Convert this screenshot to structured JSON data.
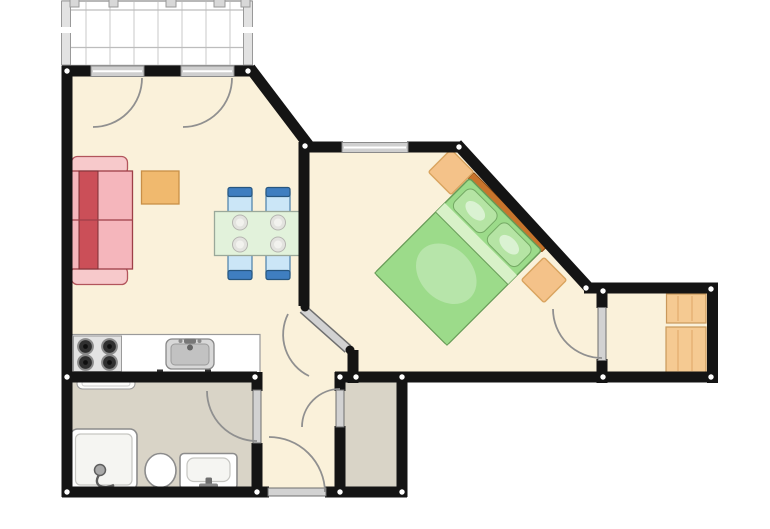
{
  "plan": {
    "colors": {
      "background": "#FFFFFF",
      "floor": "#FAF1DA",
      "wet_floor": "#D9D4C7",
      "wall": "#141414",
      "door_leaf": "#D2D2D2",
      "threshold": "#CFCFCF",
      "swing_arc": "#909090",
      "balcony_grid": "#C9C9C9",
      "balcony_rail": "#E2E2E2",
      "wood": "#F5CA92",
      "side_table_orange": "#F0B96E",
      "nightstand_orange": "#F4C289",
      "bed_green": "#9CDB8A",
      "pillow_green": "#B5E4A4",
      "sheet_green": "#D8F1C8",
      "headboard_brown": "#C8742C",
      "table_green": "#E2F2DB",
      "chair_blue": "#3F7EC0",
      "chair_seat_blue": "#CBE6F7",
      "sofa_pink": "#F5B6BC",
      "sofa_arm_pink": "#F7C9CB",
      "sofa_red": "#CB4F58",
      "counter_white": "#FFFFFF",
      "stove_gray": "#E3E3E3",
      "burner_dark": "#303030",
      "fixture_white": "#FFFFFF"
    },
    "rooms": [
      "living-room",
      "bedroom",
      "kitchen",
      "bathroom",
      "entry-hall",
      "closet",
      "storage-room",
      "balcony"
    ],
    "furniture": [
      "sofa",
      "side-table",
      "dining-table",
      "dining-chair-1",
      "dining-chair-2",
      "dining-chair-3",
      "dining-chair-4",
      "double-bed",
      "nightstand-1",
      "nightstand-2",
      "wardrobe-1",
      "wardrobe-2",
      "kitchen-counter",
      "stove",
      "kitchen-sink",
      "towel-rail",
      "shower",
      "toilet",
      "bathroom-sink"
    ],
    "doors": [
      "balcony-door-left",
      "balcony-door-right",
      "bedroom-door",
      "storage-room-door",
      "bathroom-door",
      "closet-door",
      "entrance-door"
    ],
    "windows": [
      "bedroom-window"
    ]
  }
}
